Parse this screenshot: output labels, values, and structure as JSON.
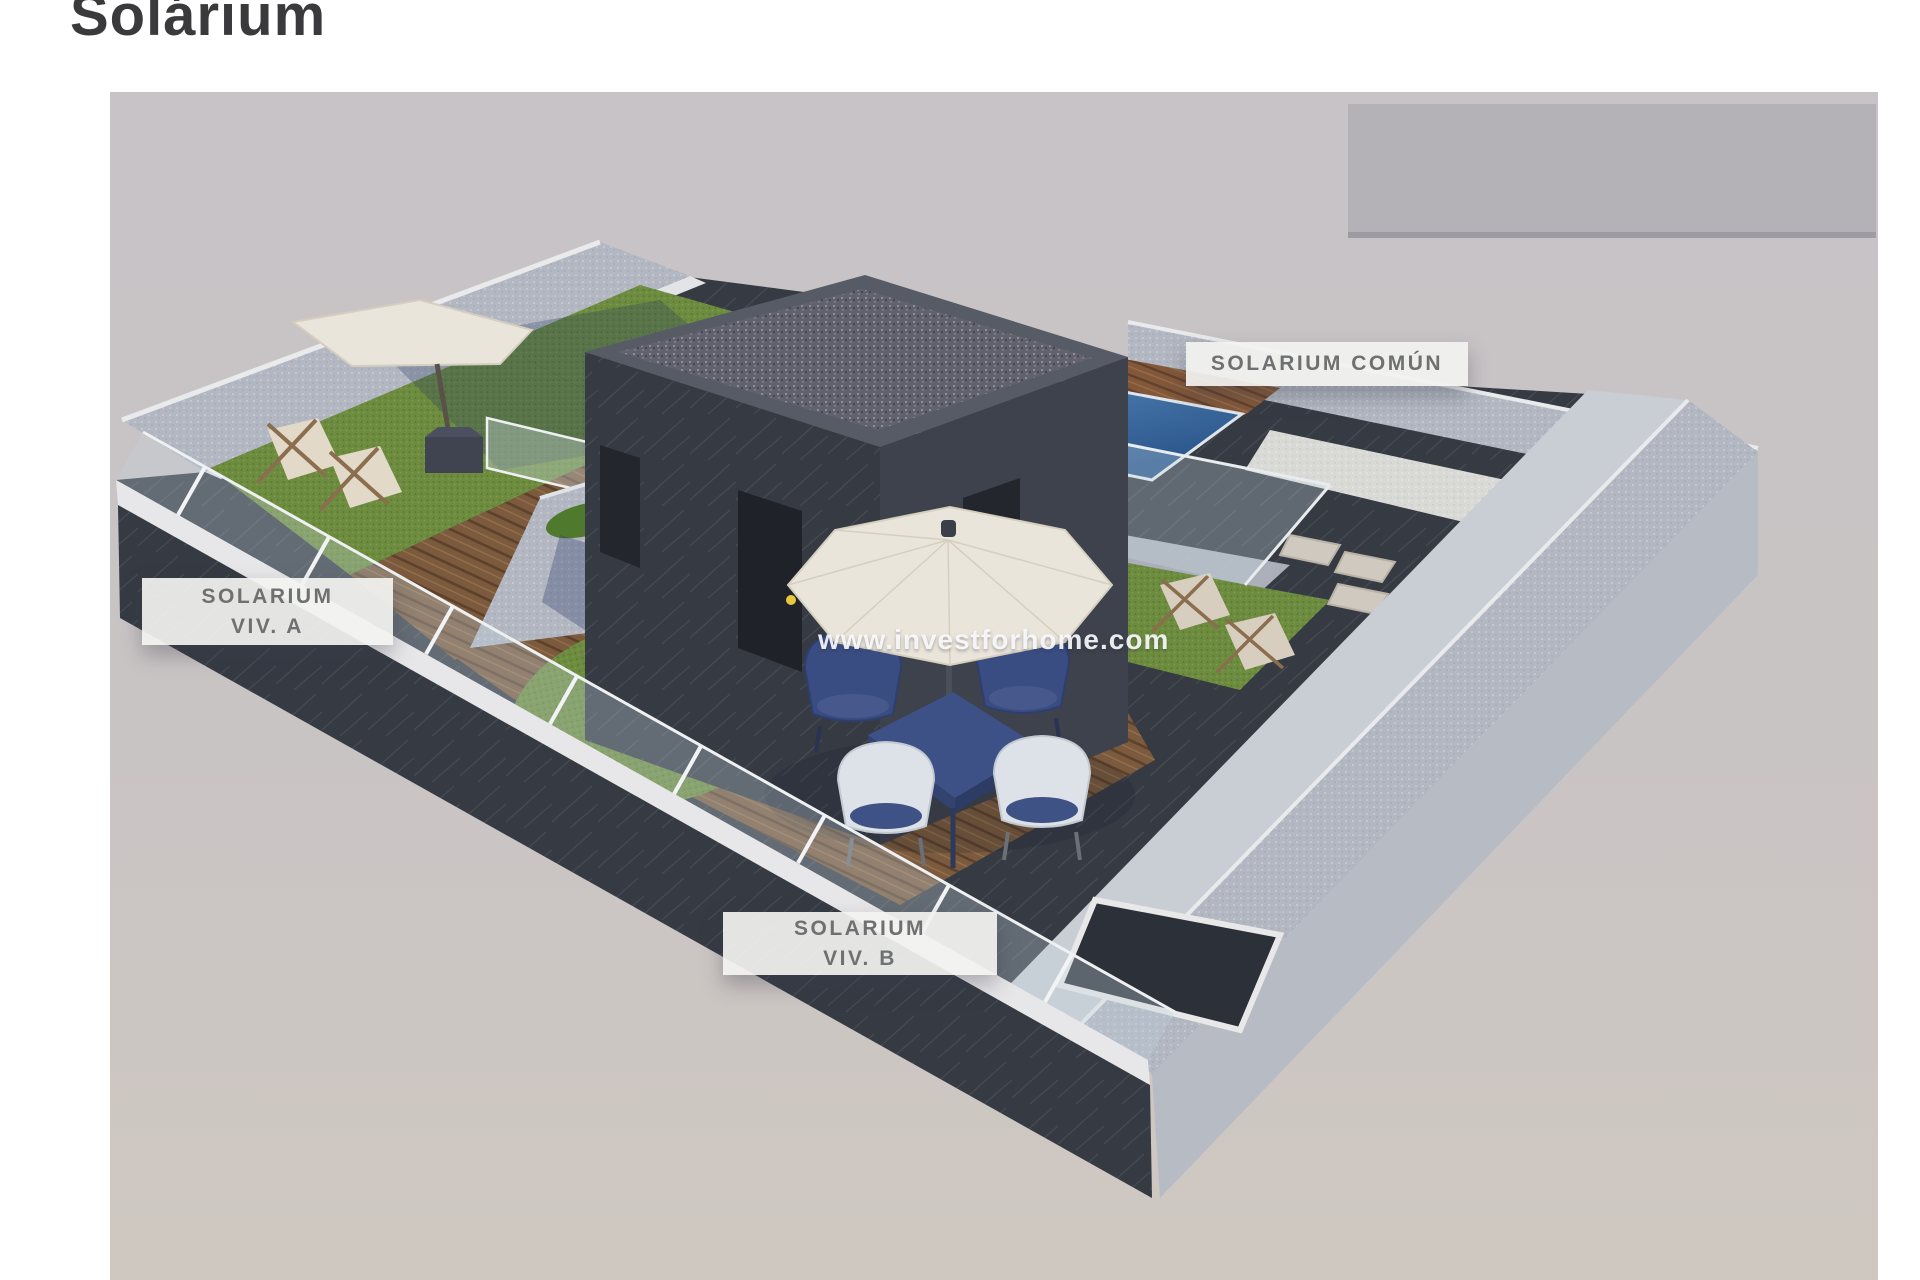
{
  "page": {
    "title": "Solárium",
    "background": "#ffffff"
  },
  "watermark": {
    "text": "www.investforhome.com"
  },
  "labels": {
    "viv_a": {
      "line1": "SOLARIUM",
      "line2": "VIV. A"
    },
    "viv_b": {
      "line1": "SOLARIUM",
      "line2": "VIV. B"
    },
    "comun": {
      "text": "SOLARIUM COMÚN"
    }
  },
  "palette": {
    "photo_bg_top": "#c7c3c6",
    "photo_bg_bottom": "#cfc8c1",
    "neighbor_block": "#b4b1b7",
    "parapet_light": "#bfc4cc",
    "coping_white": "#e9eaec",
    "dark_wall": "#353a43",
    "gravel_roof": "#62626e",
    "wood_deck": "#7b5a3d",
    "grass": "#6d8c3f",
    "pool_water": "#3f74ad",
    "parasol_cream": "#eae5da",
    "furniture_navy": "#3c4f82",
    "chair_white": "#dde2e8",
    "lounger_fabric": "#e0d7c6",
    "label_bg": "rgba(242,242,240,0.93)",
    "label_text": "#6f7071",
    "title_text": "#3a3a3c"
  },
  "scene": {
    "type": "3d-isometric-rooftop-render",
    "areas": [
      {
        "name": "solarium-viv-a",
        "features": [
          "grass lawn",
          "wood deck",
          "two sun loungers",
          "parasol with base"
        ]
      },
      {
        "name": "solarium-viv-b",
        "features": [
          "wood deck",
          "grass crescent",
          "parasol",
          "square dining table",
          "four wicker chairs"
        ]
      },
      {
        "name": "solarium-comun",
        "features": [
          "plunge pool",
          "wood pool deck",
          "wood steps",
          "glass balustrade",
          "grass with sun loungers",
          "stepping stones",
          "stairwell skylight"
        ]
      }
    ],
    "structures": [
      "penthouse stair block with gravel roof and doors",
      "perimeter parapet walls",
      "glass railing",
      "planter divider wall"
    ]
  }
}
